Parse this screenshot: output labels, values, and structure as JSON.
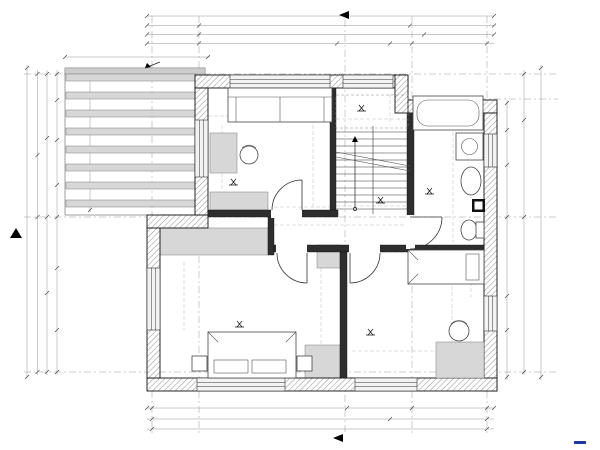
{
  "title": {
    "label": "ETAJ"
  },
  "markers": {
    "s1": "S1",
    "s2": "S2"
  },
  "annotations": {
    "pergola": "pergola de lemn, acoperit cu WPC",
    "stairs": "16 Trepte: L 27cm x H 17.5cm"
  },
  "axes": {
    "top": [
      {
        "label": "1",
        "x": 153
      },
      {
        "label": "2",
        "x": 199
      },
      {
        "label": "3",
        "x": 412
      },
      {
        "label": "4",
        "x": 487
      }
    ],
    "bottom": [
      {
        "label": "1",
        "x": 151
      },
      {
        "label": "3",
        "x": 412
      },
      {
        "label": "4",
        "x": 486
      }
    ],
    "left": [
      {
        "label": "D",
        "y": 74
      },
      {
        "label": "B",
        "y": 217
      },
      {
        "label": "A",
        "y": 372
      }
    ],
    "right": [
      {
        "label": "D",
        "y": 75
      },
      {
        "label": "C",
        "y": 99
      },
      {
        "label": "B",
        "y": 216
      },
      {
        "label": "A",
        "y": 372
      }
    ]
  },
  "rooms": [
    {
      "name": "DORMITOR 3",
      "area": "9.54 m2",
      "x": 267,
      "y": 149
    },
    {
      "name": "BAIE",
      "area": "7.16 m2",
      "x": 421,
      "y": 171
    },
    {
      "name": "HOL",
      "area": "4.32 m2",
      "x": 347,
      "y": 219
    },
    {
      "name": "DORMITOR 2",
      "area": "14.83 m2",
      "x": 213,
      "y": 303
    },
    {
      "name": "DORMITOR 1",
      "area": "14.36 m2",
      "x": 360,
      "y": 307
    }
  ],
  "dimensions": [
    {
      "t": "23",
      "x": 153,
      "y": 22,
      "s": 5.5
    },
    {
      "t": "917",
      "x": 345,
      "y": 15
    },
    {
      "t": "130",
      "x": 176,
      "y": 27
    },
    {
      "t": "539",
      "x": 306,
      "y": 27
    },
    {
      "t": "202",
      "x": 451,
      "y": 27
    },
    {
      "t": "130",
      "x": 176,
      "y": 36
    },
    {
      "t": "585",
      "x": 310,
      "y": 36
    },
    {
      "t": "202",
      "x": 452,
      "y": 36
    },
    {
      "t": "130",
      "x": 176,
      "y": 45
    },
    {
      "t": "376",
      "x": 288,
      "y": 45
    },
    {
      "t": "140",
      "x": 354,
      "y": 41,
      "s": 5
    },
    {
      "t": "70",
      "x": 354,
      "y": 47,
      "s": 5
    },
    {
      "t": "69",
      "x": 391,
      "y": 45
    },
    {
      "t": "202",
      "x": 452,
      "y": 45
    },
    {
      "t": "340",
      "x": 137,
      "y": 56
    },
    {
      "t": "70",
      "x": 359,
      "y": 64,
      "r": -90,
      "s": 5
    },
    {
      "t": "140",
      "x": 366,
      "y": 64,
      "r": -90,
      "s": 5
    },
    {
      "t": "23",
      "x": 33,
      "y": 72,
      "r": -90,
      "s": 5.5
    },
    {
      "t": "45",
      "x": 33,
      "y": 91,
      "r": -90
    },
    {
      "t": "110",
      "x": 50,
      "y": 98,
      "r": -90
    },
    {
      "t": "140",
      "x": 46,
      "y": 139,
      "r": -90,
      "s": 5.5
    },
    {
      "t": "140",
      "x": 53,
      "y": 139,
      "r": -90,
      "s": 5.5
    },
    {
      "t": "115",
      "x": 50,
      "y": 186,
      "r": -90
    },
    {
      "t": "365",
      "x": 23,
      "y": 141,
      "r": -90
    },
    {
      "t": "320",
      "x": 13,
      "y": 158,
      "r": -90
    },
    {
      "t": "365",
      "x": 94,
      "y": 141,
      "r": -90
    },
    {
      "t": "825",
      "x": 27,
      "y": 227,
      "r": -90
    },
    {
      "t": "414",
      "x": 38,
      "y": 294,
      "r": -90
    },
    {
      "t": "460",
      "x": 46,
      "y": 294,
      "r": -90
    },
    {
      "t": "130",
      "x": 57,
      "y": 236,
      "r": -90
    },
    {
      "t": "130",
      "x": 57,
      "y": 358,
      "r": -90
    },
    {
      "t": "23",
      "x": 28,
      "y": 378,
      "r": -90,
      "s": 5.5
    },
    {
      "t": "200",
      "x": 140,
      "y": 291,
      "s": 5.5
    },
    {
      "t": "150",
      "x": 140,
      "y": 299,
      "s": 5.5
    },
    {
      "t": "Hp= 90",
      "x": 154,
      "y": 297,
      "r": -90,
      "s": 5
    },
    {
      "t": "97",
      "x": 165,
      "y": 242,
      "r": -90,
      "s": 5.5
    },
    {
      "t": "97",
      "x": 165,
      "y": 347,
      "r": -90,
      "s": 5.5
    },
    {
      "t": "45",
      "x": 528,
      "y": 78,
      "r": -90
    },
    {
      "t": "23",
      "x": 546,
      "y": 73,
      "r": -90,
      "s": 5.5
    },
    {
      "t": "45",
      "x": 546,
      "y": 88,
      "r": -90
    },
    {
      "t": "125",
      "x": 530,
      "y": 115,
      "r": -90
    },
    {
      "t": "320",
      "x": 547,
      "y": 159,
      "r": -90
    },
    {
      "t": "80",
      "x": 508,
      "y": 147,
      "s": 5.5
    },
    {
      "t": "140",
      "x": 508,
      "y": 155,
      "s": 5.5
    },
    {
      "t": "80",
      "x": 526,
      "y": 147,
      "s": 5.5
    },
    {
      "t": "140",
      "x": 526,
      "y": 155,
      "s": 5.5
    },
    {
      "t": "365",
      "x": 508,
      "y": 236,
      "r": -90
    },
    {
      "t": "780",
      "x": 533,
      "y": 236,
      "r": -90
    },
    {
      "t": "825",
      "x": 548,
      "y": 227,
      "r": -90
    },
    {
      "t": "414",
      "x": 538,
      "y": 295,
      "r": -90
    },
    {
      "t": "80",
      "x": 508,
      "y": 307,
      "s": 5.5
    },
    {
      "t": "140",
      "x": 508,
      "y": 315,
      "s": 5.5
    },
    {
      "t": "80",
      "x": 526,
      "y": 307,
      "s": 5.5
    },
    {
      "t": "140",
      "x": 526,
      "y": 315,
      "s": 5.5
    },
    {
      "t": "130",
      "x": 528,
      "y": 354,
      "r": -90
    },
    {
      "t": "23",
      "x": 548,
      "y": 374,
      "r": -90,
      "s": 5.5
    },
    {
      "t": "Hp= 90",
      "x": 240,
      "y": 374,
      "s": 5.5
    },
    {
      "t": "Hp= 90",
      "x": 378,
      "y": 367,
      "s": 5.5
    },
    {
      "t": "397",
      "x": 253,
      "y": 352
    },
    {
      "t": "85",
      "x": 331,
      "y": 363,
      "s": 5.5
    },
    {
      "t": "442",
      "x": 399,
      "y": 352
    },
    {
      "t": "197",
      "x": 449,
      "y": 362
    },
    {
      "t": "160",
      "x": 365,
      "y": 388,
      "r": -90,
      "s": 5
    },
    {
      "t": "140",
      "x": 372,
      "y": 388,
      "r": -90,
      "s": 5
    },
    {
      "t": "527",
      "x": 263,
      "y": 409
    },
    {
      "t": "160",
      "x": 382,
      "y": 405,
      "s": 5
    },
    {
      "t": "140",
      "x": 382,
      "y": 412,
      "s": 5
    },
    {
      "t": "230",
      "x": 452,
      "y": 409
    },
    {
      "t": "23",
      "x": 152,
      "y": 414,
      "s": 5.5
    },
    {
      "t": "23",
      "x": 492,
      "y": 414,
      "s": 5.5
    },
    {
      "t": "669",
      "x": 288,
      "y": 420
    },
    {
      "t": "202",
      "x": 452,
      "y": 420
    },
    {
      "t": "917",
      "x": 345,
      "y": 430
    },
    {
      "t": "295",
      "x": 268,
      "y": 119
    },
    {
      "t": "353",
      "x": 226,
      "y": 154,
      "r": -90
    },
    {
      "t": "13",
      "x": 202,
      "y": 117,
      "s": 5
    },
    {
      "t": "140",
      "x": 200,
      "y": 143,
      "r": -90,
      "s": 5
    },
    {
      "t": "Hp= 90",
      "x": 208,
      "y": 147,
      "r": -90,
      "s": 5
    },
    {
      "t": "145",
      "x": 248,
      "y": 175
    },
    {
      "t": "20",
      "x": 271,
      "y": 181,
      "s": 5.5
    },
    {
      "t": "35",
      "x": 310,
      "y": 181,
      "s": 5.5
    },
    {
      "t": "90",
      "x": 286,
      "y": 194,
      "r": -90,
      "s": 5.5
    },
    {
      "t": "210",
      "x": 293,
      "y": 194,
      "r": -90,
      "s": 5.5
    },
    {
      "t": "316",
      "x": 317,
      "y": 135,
      "r": -90
    },
    {
      "t": "150",
      "x": 240,
      "y": 212
    },
    {
      "t": "280",
      "x": 218,
      "y": 241
    },
    {
      "t": "52",
      "x": 261,
      "y": 205,
      "r": -90,
      "s": 5
    },
    {
      "t": "115",
      "x": 280,
      "y": 221,
      "r": -90,
      "s": 5
    },
    {
      "t": "+3.15",
      "x": 247,
      "y": 185
    },
    {
      "t": "Hp= 3",
      "x": 364,
      "y": 89,
      "s": 5.5
    },
    {
      "t": "Hp= 118",
      "x": 366,
      "y": 96,
      "s": 5.5
    },
    {
      "t": "+1.75",
      "x": 375,
      "y": 111
    },
    {
      "t": "212",
      "x": 367,
      "y": 122
    },
    {
      "t": "110",
      "x": 393,
      "y": 102,
      "r": -90
    },
    {
      "t": "105",
      "x": 390,
      "y": 146
    },
    {
      "t": "89",
      "x": 393,
      "y": 161,
      "r": -90,
      "s": 5.5
    },
    {
      "t": "27",
      "x": 376,
      "y": 192,
      "r": -90,
      "s": 5.5
    },
    {
      "t": "+3.15",
      "x": 394,
      "y": 203
    },
    {
      "t": "212",
      "x": 367,
      "y": 211
    },
    {
      "t": "145",
      "x": 290,
      "y": 210
    },
    {
      "t": "120",
      "x": 329,
      "y": 221,
      "r": -90,
      "s": 5.5
    },
    {
      "t": "120",
      "x": 406,
      "y": 221,
      "r": -90,
      "s": 5.5
    },
    {
      "t": "357",
      "x": 336,
      "y": 230
    },
    {
      "t": "80",
      "x": 330,
      "y": 258,
      "s": 5.5
    },
    {
      "t": "80",
      "x": 417,
      "y": 214,
      "r": -90,
      "s": 5.5
    },
    {
      "t": "210",
      "x": 424,
      "y": 214,
      "r": -90,
      "s": 5.5
    },
    {
      "t": "190",
      "x": 449,
      "y": 122
    },
    {
      "t": "92",
      "x": 480,
      "y": 118,
      "r": -90,
      "s": 5.5
    },
    {
      "t": "377",
      "x": 457,
      "y": 172,
      "r": -90
    },
    {
      "t": "MS",
      "x": 469,
      "y": 145,
      "r": -90,
      "s": 5.5
    },
    {
      "t": "Hp= 90",
      "x": 479,
      "y": 150,
      "r": -90,
      "s": 5
    },
    {
      "t": "60",
      "x": 456,
      "y": 183,
      "r": -90,
      "s": 5.5
    },
    {
      "t": "33",
      "x": 457,
      "y": 207,
      "r": -90,
      "s": 5.5
    },
    {
      "t": "60",
      "x": 454,
      "y": 232,
      "r": -90,
      "s": 5.5
    },
    {
      "t": "+3.15",
      "x": 443,
      "y": 194
    },
    {
      "t": "384",
      "x": 187,
      "y": 294,
      "r": -90
    },
    {
      "t": "20",
      "x": 270,
      "y": 252,
      "s": 5.5
    },
    {
      "t": "90",
      "x": 284,
      "y": 249,
      "r": -90,
      "s": 5.5
    },
    {
      "t": "210",
      "x": 291,
      "y": 249,
      "r": -90,
      "s": 5.5
    },
    {
      "t": "117",
      "x": 292,
      "y": 275
    },
    {
      "t": "325",
      "x": 324,
      "y": 309,
      "r": -90
    },
    {
      "t": "+3.15",
      "x": 253,
      "y": 327
    },
    {
      "t": "274",
      "x": 433,
      "y": 257
    },
    {
      "t": "90",
      "x": 358,
      "y": 249,
      "r": -90,
      "s": 5.5
    },
    {
      "t": "210",
      "x": 365,
      "y": 249,
      "r": -90,
      "s": 5.5
    },
    {
      "t": "148",
      "x": 475,
      "y": 275,
      "r": -90
    },
    {
      "t": "325",
      "x": 456,
      "y": 307,
      "r": -90
    },
    {
      "t": "Hp= 90",
      "x": 483,
      "y": 316,
      "r": -90,
      "s": 5
    },
    {
      "t": "97",
      "x": 479,
      "y": 351,
      "r": -90,
      "s": 5.5
    },
    {
      "t": "+3.15",
      "x": 384,
      "y": 335
    }
  ]
}
